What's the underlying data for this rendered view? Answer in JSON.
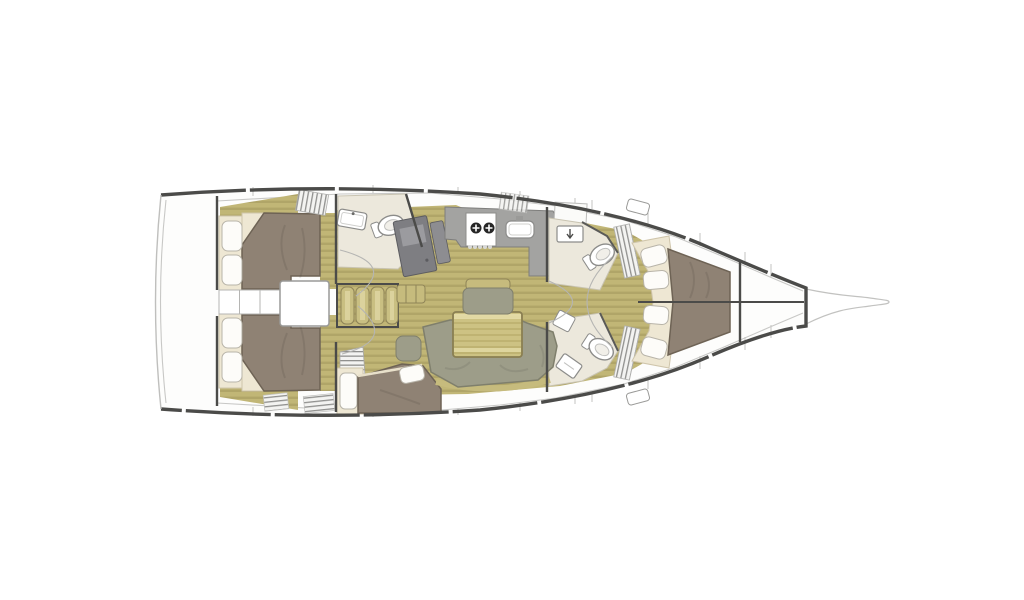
{
  "meta": {
    "type": "yacht-interior-floor-plan",
    "view": "top-down",
    "orientation": "bow-right",
    "visible_text": ""
  },
  "colors": {
    "background": "#ffffff",
    "hull_fill": "#fdfdfc",
    "hull_stroke": "#4b4b49",
    "thin_line": "#c2c2c0",
    "inner_line": "#c8c8c6",
    "floor_base": "#c1b676",
    "floor_stripe": "#a1965c",
    "trim_khaki": "#c6bb7d",
    "step_tread": "#c9bf82",
    "step_edge": "#8f8457",
    "table_base": "#cdc283",
    "table_stripe": "#b5a967",
    "table_light": "#e6dda9",
    "table_edge": "#8a7f52",
    "bed_brown": "#8f8274",
    "bed_edge": "#6e6355",
    "cream": "#eee7d3",
    "cream_edge": "#cfc5ab",
    "pillow": "#fdfcf9",
    "pillow_edge": "#b8b4a9",
    "sage": "#9d9d89",
    "sage_edge": "#7f7f6c",
    "counter_gray": "#a3a3a1",
    "counter_edge": "#7e7e7c",
    "chart_gray": "#7e7e82",
    "chart_light": "#9b9b9f",
    "fixture_white": "#ffffff",
    "fixture_edge": "#8c8c8a",
    "head_floor": "#ece8dc",
    "head_floor_edge": "#c9c4b2",
    "louver_bg": "#f3f3f1",
    "louver_line": "#90908e",
    "burner_dark": "#262626"
  },
  "vessel": {
    "hull": {
      "name": "sailboat-hull",
      "stern": "left",
      "bow": "right"
    },
    "regions": [
      {
        "id": "swim-platform",
        "label": "stern swim platform"
      },
      {
        "id": "aft-cabin-port",
        "label": "aft double cabin (top)",
        "pillows": 2
      },
      {
        "id": "aft-cabin-starboard",
        "label": "aft double cabin (bottom)",
        "pillows": 2
      },
      {
        "id": "midship-berth",
        "label": "athwartship berth (bottom center)",
        "pillows": 2
      },
      {
        "id": "engine-compartment",
        "label": "engine box under companionway"
      },
      {
        "id": "companionway-steps",
        "label": "companionway steps",
        "step_count": 4
      },
      {
        "id": "aft-head",
        "label": "aft head with sink and toilet"
      },
      {
        "id": "nav-station",
        "label": "chart table / nav desk"
      },
      {
        "id": "galley",
        "label": "galley",
        "stove_burners": 2,
        "sinks": 1
      },
      {
        "id": "forward-head-port",
        "label": "forward head (top)",
        "fixtures": [
          "sink",
          "toilet"
        ]
      },
      {
        "id": "forward-head-starboard",
        "label": "forward head (bottom)",
        "fixtures": [
          "toilet",
          "sink"
        ]
      },
      {
        "id": "saloon",
        "label": "saloon",
        "furniture": [
          "U-settee",
          "dining-table",
          "armchair",
          "bench"
        ]
      },
      {
        "id": "owner-cabin",
        "label": "forward owner cabin",
        "side_cushions": 8
      },
      {
        "id": "bowsprit",
        "label": "bowsprit"
      }
    ]
  }
}
